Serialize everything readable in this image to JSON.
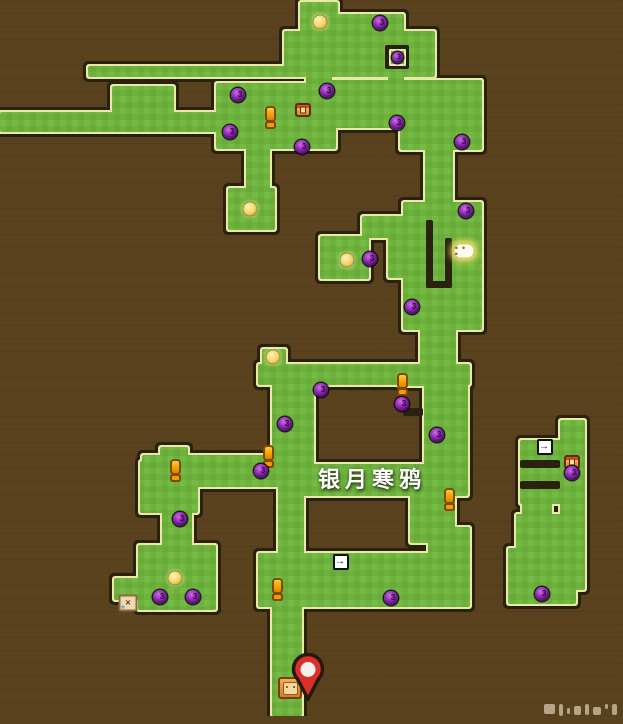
{
  "map": {
    "area_label": {
      "text": "银月寒鸦"
    },
    "enemy_level": "3",
    "glyphs": {
      "door": "→",
      "bubble": "● ● ●",
      "letter": "×"
    },
    "colors": {
      "background": "#5a421f",
      "path_green": "#6cb23d",
      "path_green_alt": "#74ba45",
      "path_border": "#ece8a9",
      "path_outline": "#28220f",
      "pin_red": "#dd2f2a",
      "orb_purple": "#8a24ad",
      "coin_yellow": "#f5d264",
      "exclaim_orange": "#f59d00"
    },
    "rooms": [
      [
        300,
        2,
        38,
        32
      ],
      [
        332,
        14,
        72,
        18
      ],
      [
        284,
        31,
        151,
        46
      ],
      [
        88,
        66,
        200,
        11
      ],
      [
        306,
        70,
        26,
        18
      ],
      [
        388,
        72,
        16,
        14
      ],
      [
        0,
        112,
        116,
        20
      ],
      [
        112,
        86,
        62,
        46
      ],
      [
        168,
        112,
        54,
        20
      ],
      [
        216,
        83,
        120,
        66
      ],
      [
        330,
        80,
        152,
        48
      ],
      [
        400,
        80,
        82,
        70
      ],
      [
        246,
        145,
        24,
        50
      ],
      [
        228,
        188,
        47,
        42
      ],
      [
        425,
        145,
        28,
        62
      ],
      [
        403,
        202,
        79,
        128
      ],
      [
        388,
        216,
        26,
        62
      ],
      [
        362,
        216,
        52,
        22
      ],
      [
        320,
        236,
        49,
        43
      ],
      [
        420,
        296,
        36,
        80
      ],
      [
        398,
        368,
        58,
        18
      ],
      [
        258,
        364,
        212,
        21
      ],
      [
        262,
        349,
        24,
        20
      ],
      [
        286,
        380,
        28,
        110
      ],
      [
        424,
        380,
        44,
        112
      ],
      [
        286,
        464,
        182,
        32
      ],
      [
        272,
        380,
        30,
        100
      ],
      [
        278,
        475,
        26,
        95
      ],
      [
        142,
        455,
        150,
        32
      ],
      [
        160,
        447,
        28,
        12
      ],
      [
        140,
        461,
        58,
        52
      ],
      [
        162,
        506,
        30,
        45
      ],
      [
        138,
        545,
        78,
        65
      ],
      [
        114,
        578,
        28,
        22
      ],
      [
        258,
        553,
        212,
        54
      ],
      [
        410,
        488,
        45,
        55
      ],
      [
        428,
        527,
        42,
        40
      ],
      [
        272,
        600,
        30,
        116
      ],
      [
        560,
        420,
        25,
        170
      ],
      [
        520,
        440,
        48,
        64
      ],
      [
        522,
        500,
        30,
        20
      ],
      [
        516,
        514,
        48,
        42
      ],
      [
        508,
        548,
        68,
        56
      ]
    ],
    "walls": [
      [
        426,
        220,
        7,
        68
      ],
      [
        426,
        281,
        26,
        7
      ],
      [
        445,
        238,
        7,
        50
      ],
      [
        403,
        408,
        20,
        8
      ],
      [
        520,
        460,
        40,
        8
      ],
      [
        520,
        481,
        40,
        8
      ]
    ],
    "icons": [
      {
        "type": "coin",
        "x": 320,
        "y": 22
      },
      {
        "type": "enemy-orb",
        "x": 380,
        "y": 23
      },
      {
        "type": "enemy-orb-framed",
        "x": 397,
        "y": 57
      },
      {
        "type": "enemy-orb",
        "x": 238,
        "y": 95
      },
      {
        "type": "enemy-orb",
        "x": 327,
        "y": 91
      },
      {
        "type": "chest",
        "x": 303,
        "y": 110
      },
      {
        "type": "exclaim",
        "x": 270,
        "y": 118
      },
      {
        "type": "enemy-orb",
        "x": 230,
        "y": 132
      },
      {
        "type": "enemy-orb",
        "x": 302,
        "y": 147
      },
      {
        "type": "enemy-orb",
        "x": 397,
        "y": 123
      },
      {
        "type": "enemy-orb",
        "x": 462,
        "y": 142
      },
      {
        "type": "coin",
        "x": 250,
        "y": 209
      },
      {
        "type": "enemy-orb",
        "x": 466,
        "y": 211
      },
      {
        "type": "coin",
        "x": 347,
        "y": 260
      },
      {
        "type": "enemy-orb",
        "x": 370,
        "y": 259
      },
      {
        "type": "bubble",
        "x": 464,
        "y": 251
      },
      {
        "type": "enemy-orb",
        "x": 412,
        "y": 307
      },
      {
        "type": "coin",
        "x": 273,
        "y": 357
      },
      {
        "type": "enemy-orb",
        "x": 321,
        "y": 390
      },
      {
        "type": "exclaim",
        "x": 402,
        "y": 385
      },
      {
        "type": "enemy-orb",
        "x": 402,
        "y": 404
      },
      {
        "type": "enemy-orb",
        "x": 285,
        "y": 424
      },
      {
        "type": "enemy-orb",
        "x": 437,
        "y": 435
      },
      {
        "type": "exclaim",
        "x": 175,
        "y": 471
      },
      {
        "type": "exclaim",
        "x": 268,
        "y": 457
      },
      {
        "type": "enemy-orb",
        "x": 261,
        "y": 471
      },
      {
        "type": "exclaim",
        "x": 449,
        "y": 500
      },
      {
        "type": "enemy-orb",
        "x": 180,
        "y": 519
      },
      {
        "type": "letter",
        "x": 128,
        "y": 589
      },
      {
        "type": "coin",
        "x": 175,
        "y": 578
      },
      {
        "type": "enemy-orb",
        "x": 160,
        "y": 597
      },
      {
        "type": "enemy-orb",
        "x": 193,
        "y": 597
      },
      {
        "type": "door",
        "x": 341,
        "y": 562
      },
      {
        "type": "enemy-orb",
        "x": 391,
        "y": 598
      },
      {
        "type": "exclaim",
        "x": 277,
        "y": 590
      },
      {
        "type": "chest",
        "x": 572,
        "y": 431
      },
      {
        "type": "door",
        "x": 545,
        "y": 447
      },
      {
        "type": "enemy-orb",
        "x": 572,
        "y": 473
      },
      {
        "type": "enemy-orb",
        "x": 542,
        "y": 594
      },
      {
        "type": "crate",
        "x": 290,
        "y": 688
      },
      {
        "type": "pin",
        "x": 286,
        "y": 651
      }
    ]
  },
  "watermark": {
    "present": true
  }
}
